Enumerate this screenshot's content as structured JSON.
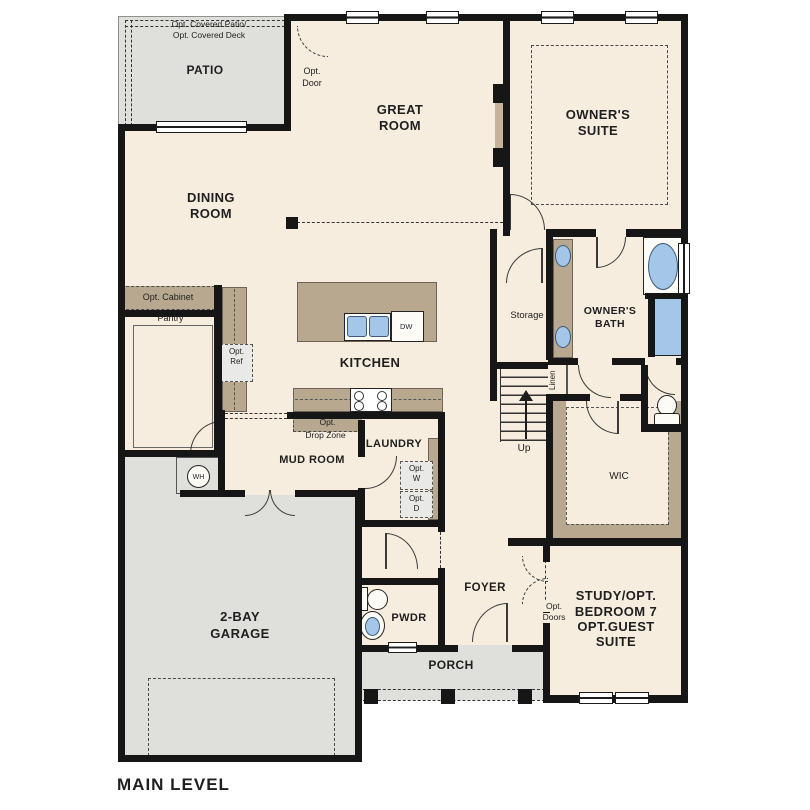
{
  "title": "MAIN LEVEL",
  "colors": {
    "floor": "#f6edde",
    "outdoor_concrete": "#dfdfdb",
    "counter_tan": "#b7a88f",
    "wall": "#161616",
    "fixture_blue": "#a4c6e8"
  },
  "labels": {
    "patio_note1": "Opt. Covered Patio/",
    "patio_note2": "Opt. Covered Deck",
    "patio": "PATIO",
    "opt_door1": "Opt.",
    "opt_door2": "Door",
    "great1": "GREAT",
    "great2": "ROOM",
    "suite1": "OWNER'S",
    "suite2": "SUITE",
    "dining1": "DINING",
    "dining2": "ROOM",
    "opt_cabinet": "Opt. Cabinet",
    "pantry": "Pantry",
    "opt_ref1": "Opt.",
    "opt_ref2": "Ref",
    "kitchen": "KITCHEN",
    "dw": "DW",
    "storage": "Storage",
    "bath1": "OWNER'S",
    "bath2": "BATH",
    "linen": "Linen",
    "up": "Up",
    "wic": "WIC",
    "dropzone1": "Opt.",
    "dropzone2": "Drop Zone",
    "mud_room": "MUD ROOM",
    "laundry": "LAUNDRY",
    "opt_w1": "Opt.",
    "opt_w2": "W",
    "opt_d1": "Opt.",
    "opt_d2": "D",
    "wh": "WH",
    "garage1": "2-BAY",
    "garage2": "GARAGE",
    "foyer": "FOYER",
    "pwdr": "PWDR",
    "porch": "PORCH",
    "opt_doors1": "Opt.",
    "opt_doors2": "Doors",
    "study1": "STUDY/OPT.",
    "study2": "BEDROOM 7",
    "study3": "OPT.GUEST",
    "study4": "SUITE"
  }
}
